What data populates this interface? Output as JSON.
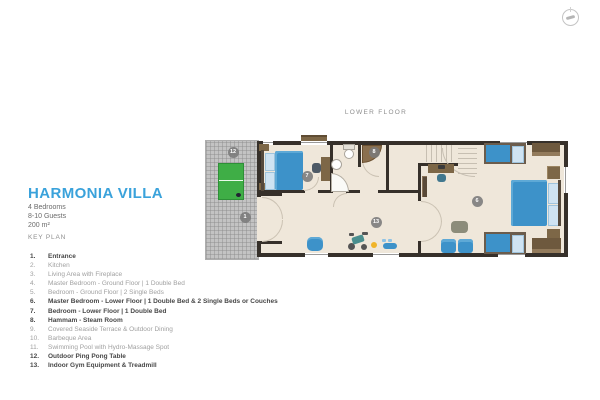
{
  "header": {
    "title": "HARMONIA VILLA",
    "meta": [
      "4 Bedrooms",
      "8-10 Guests",
      "200 m²"
    ],
    "key_plan_label": "KEY PLAN"
  },
  "key_plan": {
    "items": [
      {
        "num": "1.",
        "label": "Entrance",
        "bold": true
      },
      {
        "num": "2.",
        "label": "Kitchen",
        "bold": false
      },
      {
        "num": "3.",
        "label": "Living Area with Fireplace",
        "bold": false
      },
      {
        "num": "4.",
        "label": "Master Bedroom - Ground Floor | 1 Double Bed",
        "bold": false
      },
      {
        "num": "5.",
        "label": "Bedroom - Ground Floor | 2 Single Beds",
        "bold": false
      },
      {
        "num": "6.",
        "label": "Master Bedroom - Lower Floor | 1 Double Bed & 2 Single Beds or Couches",
        "bold": true
      },
      {
        "num": "7.",
        "label": "Bedroom - Lower Floor | 1 Double Bed",
        "bold": true
      },
      {
        "num": "8.",
        "label": "Hammam - Steam Room",
        "bold": true
      },
      {
        "num": "9.",
        "label": "Covered Seaside Terrace & Outdoor Dining",
        "bold": false
      },
      {
        "num": "10.",
        "label": "Barbeque Area",
        "bold": false
      },
      {
        "num": "11.",
        "label": "Swimming Pool with Hydro-Massage Spot",
        "bold": false
      },
      {
        "num": "12.",
        "label": "Outdoor Ping Pong Table",
        "bold": true
      },
      {
        "num": "13.",
        "label": "Indoor Gym Equipment & Treadmill",
        "bold": true
      }
    ]
  },
  "plan": {
    "floor_label": "LOWER FLOOR",
    "markers": [
      {
        "n": "1",
        "x": 245,
        "y": 217
      },
      {
        "n": "6",
        "x": 477,
        "y": 201
      },
      {
        "n": "7",
        "x": 307,
        "y": 176
      },
      {
        "n": "8",
        "x": 374,
        "y": 152
      },
      {
        "n": "12",
        "x": 233,
        "y": 152
      },
      {
        "n": "13",
        "x": 376,
        "y": 222
      }
    ],
    "colors": {
      "accent": "#3aa2db",
      "wall": "#36302a",
      "floor": "#efe7da",
      "furniture_blue": "#3d92c9",
      "table_green": "#3fae46",
      "terrace_gray": "#c3c3c3",
      "marker_gray": "#7a7a7a"
    }
  }
}
